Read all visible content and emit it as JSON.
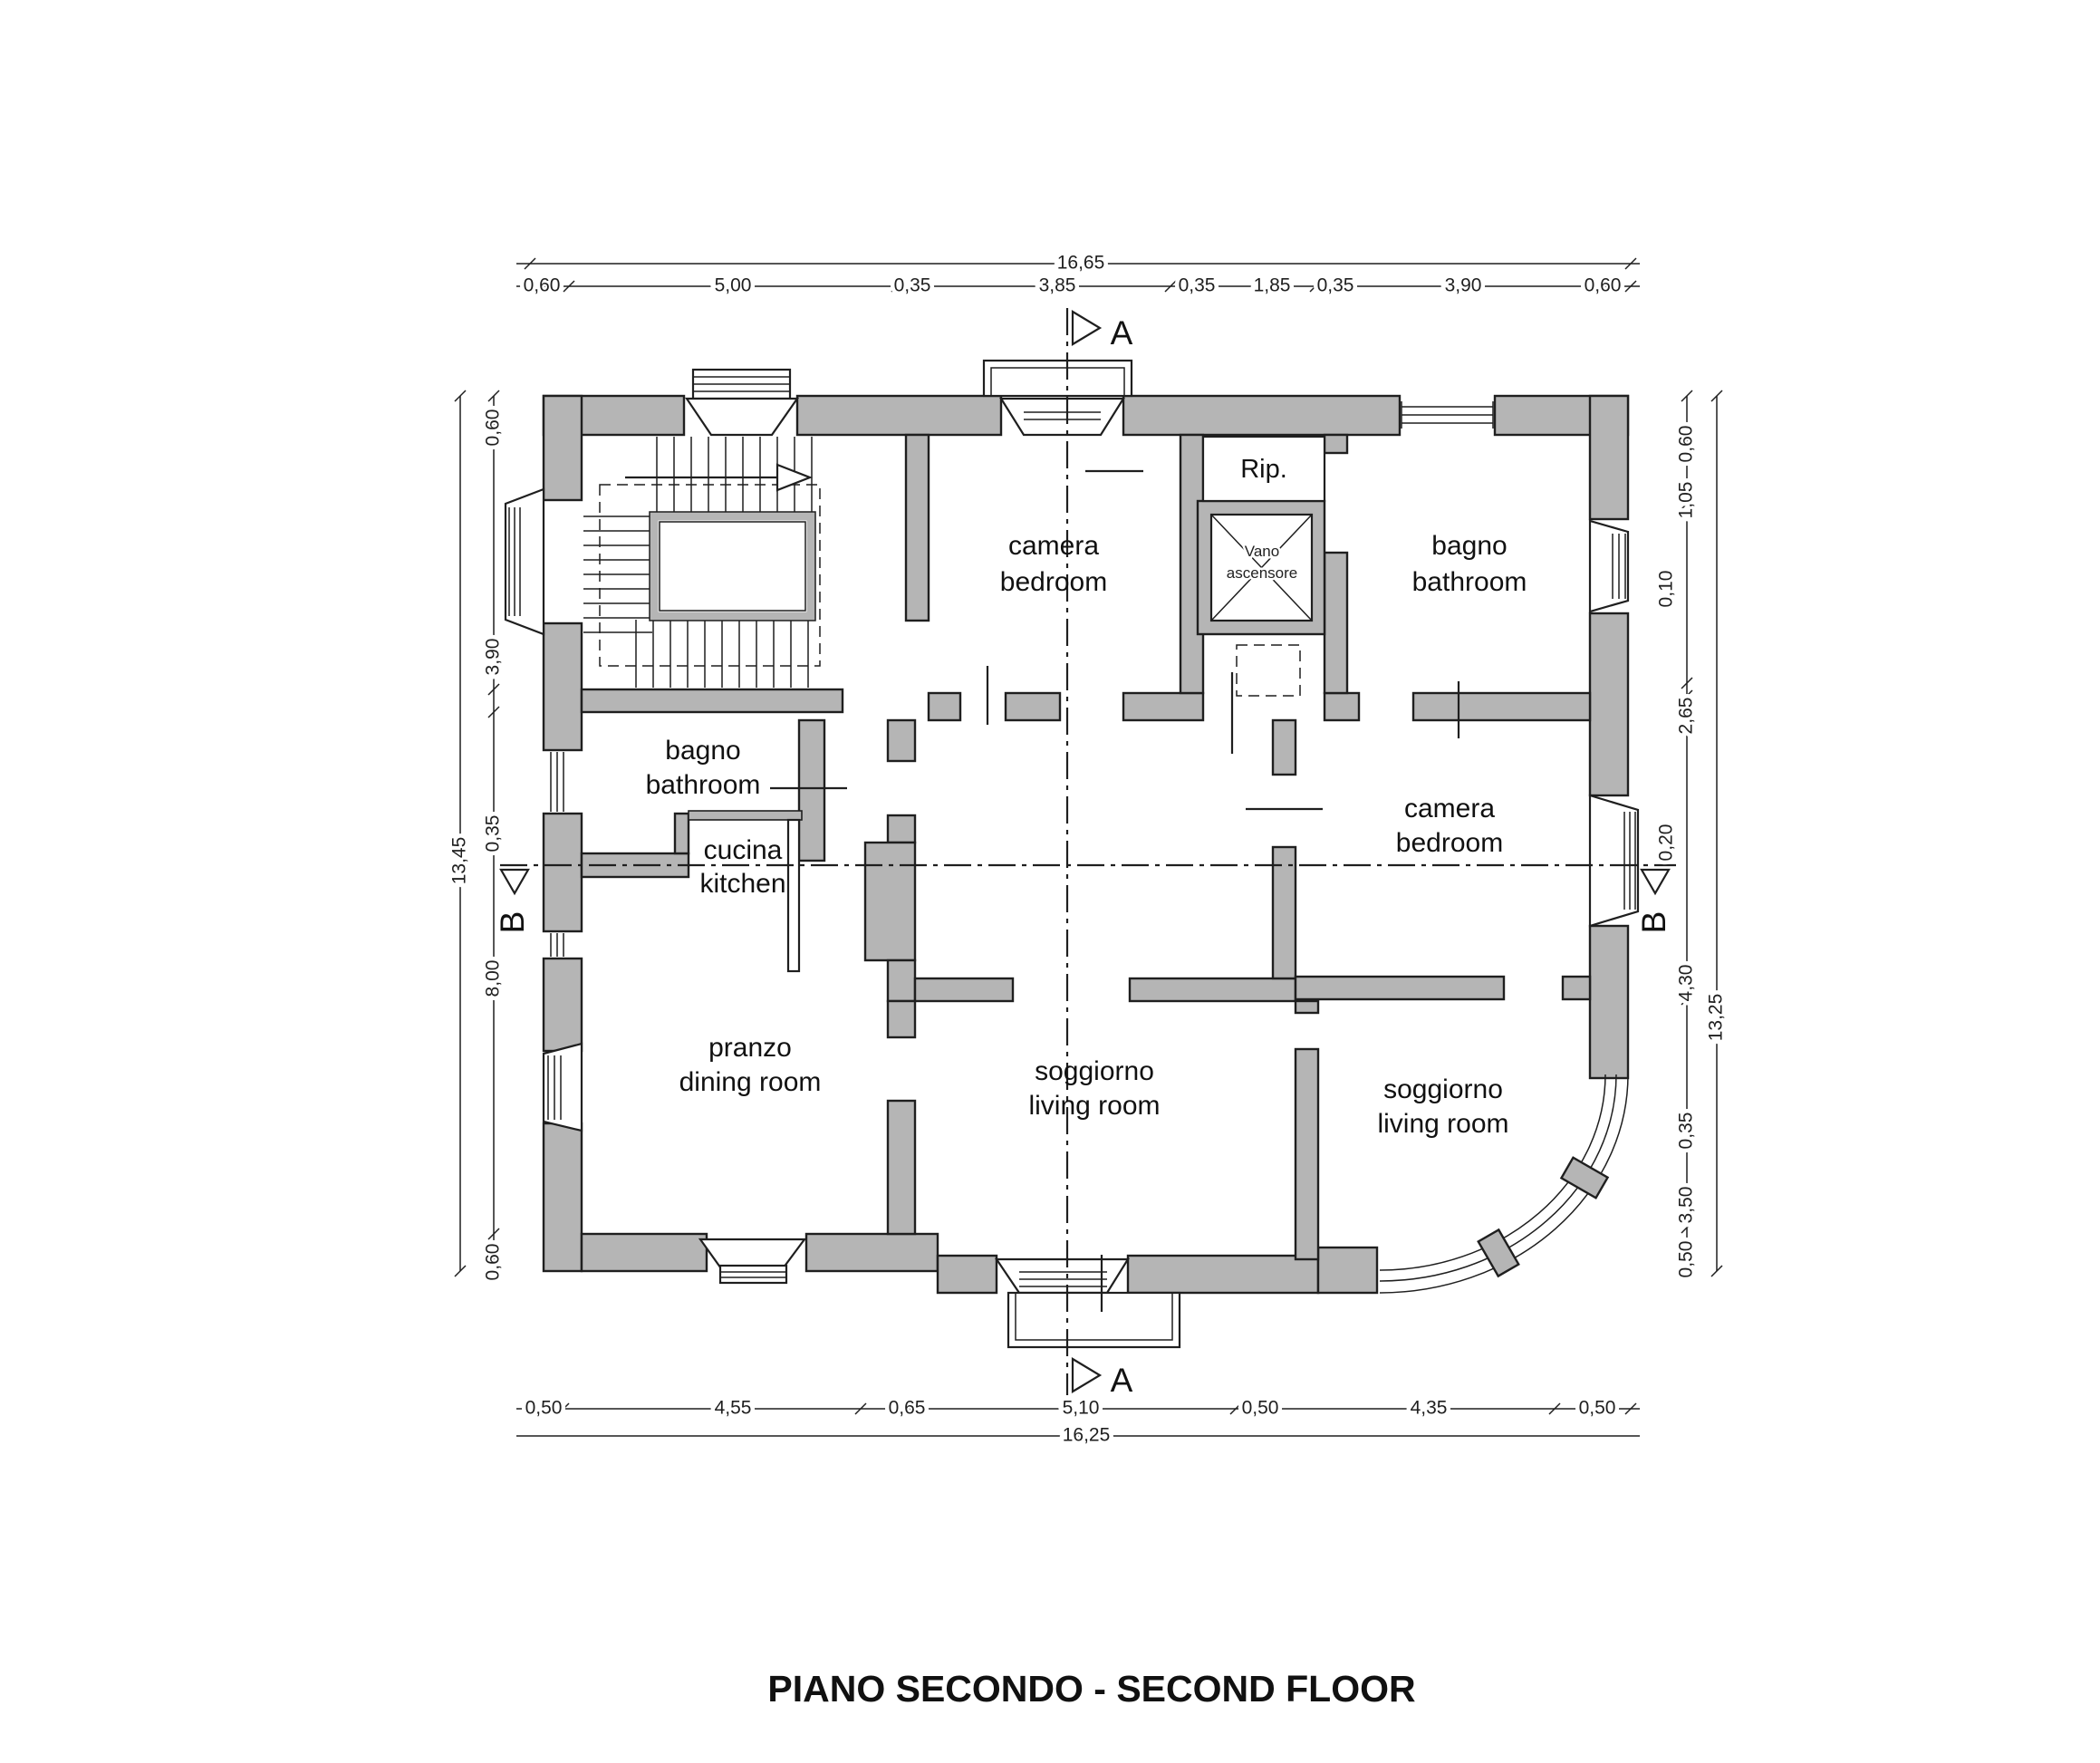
{
  "title": "PIANO SECONDO - SECOND FLOOR",
  "colors": {
    "wall": "#b5b5b5",
    "line": "#1f1f1f",
    "background": "#ffffff"
  },
  "rooms": {
    "bedroom_top": {
      "line1": "camera",
      "line2": "bedroom"
    },
    "storage": {
      "label": "Rip."
    },
    "elevator": {
      "line1": "Vano",
      "line2": "ascensore"
    },
    "bathroom_right": {
      "line1": "bagno",
      "line2": "bathroom"
    },
    "bathroom_left": {
      "line1": "bagno",
      "line2": "bathroom"
    },
    "kitchen": {
      "line1": "cucina",
      "line2": "kitchen"
    },
    "bedroom_right": {
      "line1": "camera",
      "line2": "bedroom"
    },
    "dining": {
      "line1": "pranzo",
      "line2": "dining room"
    },
    "living_center": {
      "line1": "soggiorno",
      "line2": "living room"
    },
    "living_right": {
      "line1": "soggiorno",
      "line2": "living room"
    }
  },
  "dimensions": {
    "top": {
      "total": "16,65",
      "segments": [
        "0,60",
        "5,00",
        "0,35",
        "3,85",
        "0,35",
        "1,85",
        "0,35",
        "3,90",
        "0,60"
      ]
    },
    "bottom": {
      "total": "16,25",
      "segments": [
        "0,50",
        "4,55",
        "0,65",
        "5,10",
        "0,50",
        "4,35",
        "0,50"
      ]
    },
    "left": {
      "total": "13,45",
      "segments": [
        "0,60",
        "3,90",
        "0,35",
        "8,00",
        "0,60"
      ]
    },
    "right": {
      "total": "13,25",
      "segments": [
        "0,60",
        "1,05",
        "0,10",
        "2,65",
        "0,20",
        "4,30",
        "0,35",
        "3,50",
        "0,50"
      ]
    }
  },
  "sections": {
    "a": "A",
    "b": "B"
  }
}
